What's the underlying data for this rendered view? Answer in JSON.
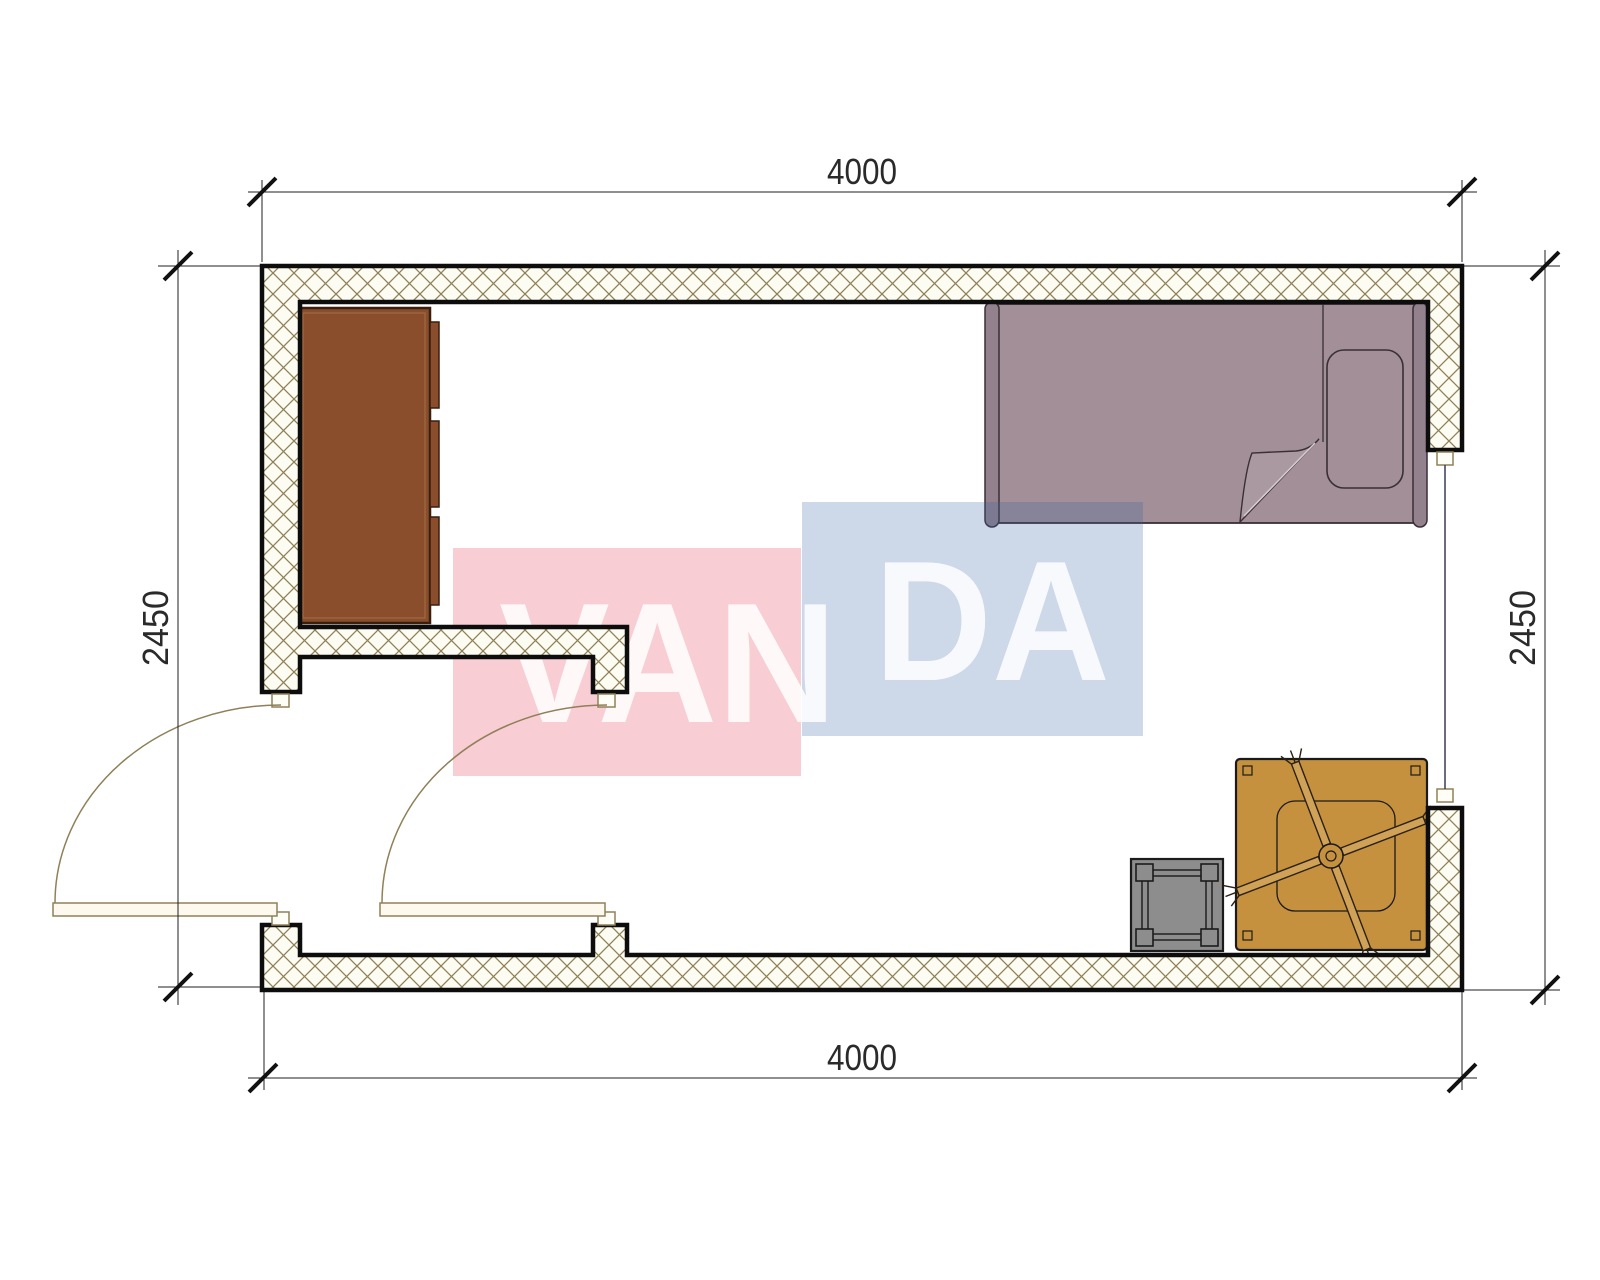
{
  "dimensions": {
    "top": "4000",
    "bottom": "4000",
    "left": "2450",
    "right": "2450"
  },
  "watermark": {
    "part1": "VAN",
    "part2": "DA",
    "pink_fill": "rgba(222,20,50,0.21)",
    "blue_fill": "rgba(56,100,164,0.25)",
    "text_color": "rgba(255,255,255,0.85)"
  },
  "colors": {
    "wall_fill": "#fdfcf2",
    "hatch_line": "#8f8058",
    "wall_stroke": "#0d0d0d",
    "door_line": "#8f8058",
    "door_leaf_fill": "#fdf9ee",
    "jamb_fill": "#fffef6",
    "cabinet": "#8a4e2d",
    "cabinet_edge": "#3a1e0e",
    "cabinet_inner": "#a06a42",
    "bed": "#a28f97",
    "bed_rail": "#93818d",
    "bed_edge": "#3a2f36",
    "bed_fold": "#ab99a1",
    "bed_fold_highlight": "#d8cdd2",
    "table": "#c5913f",
    "fan_arm": "#cfa257",
    "fan_edge": "#2a2014",
    "stool": "#8d8d8d",
    "stool_edge": "#1b1b1b",
    "dimension_color": "#2a2a2a"
  },
  "symbols": {
    "wardrobe": "wardrobe",
    "bed": "single-bed",
    "stool": "stool",
    "fan_table": "table-with-ceiling-fan",
    "door_left": "swing-door",
    "door_interior": "swing-door",
    "window": "window-opening"
  }
}
